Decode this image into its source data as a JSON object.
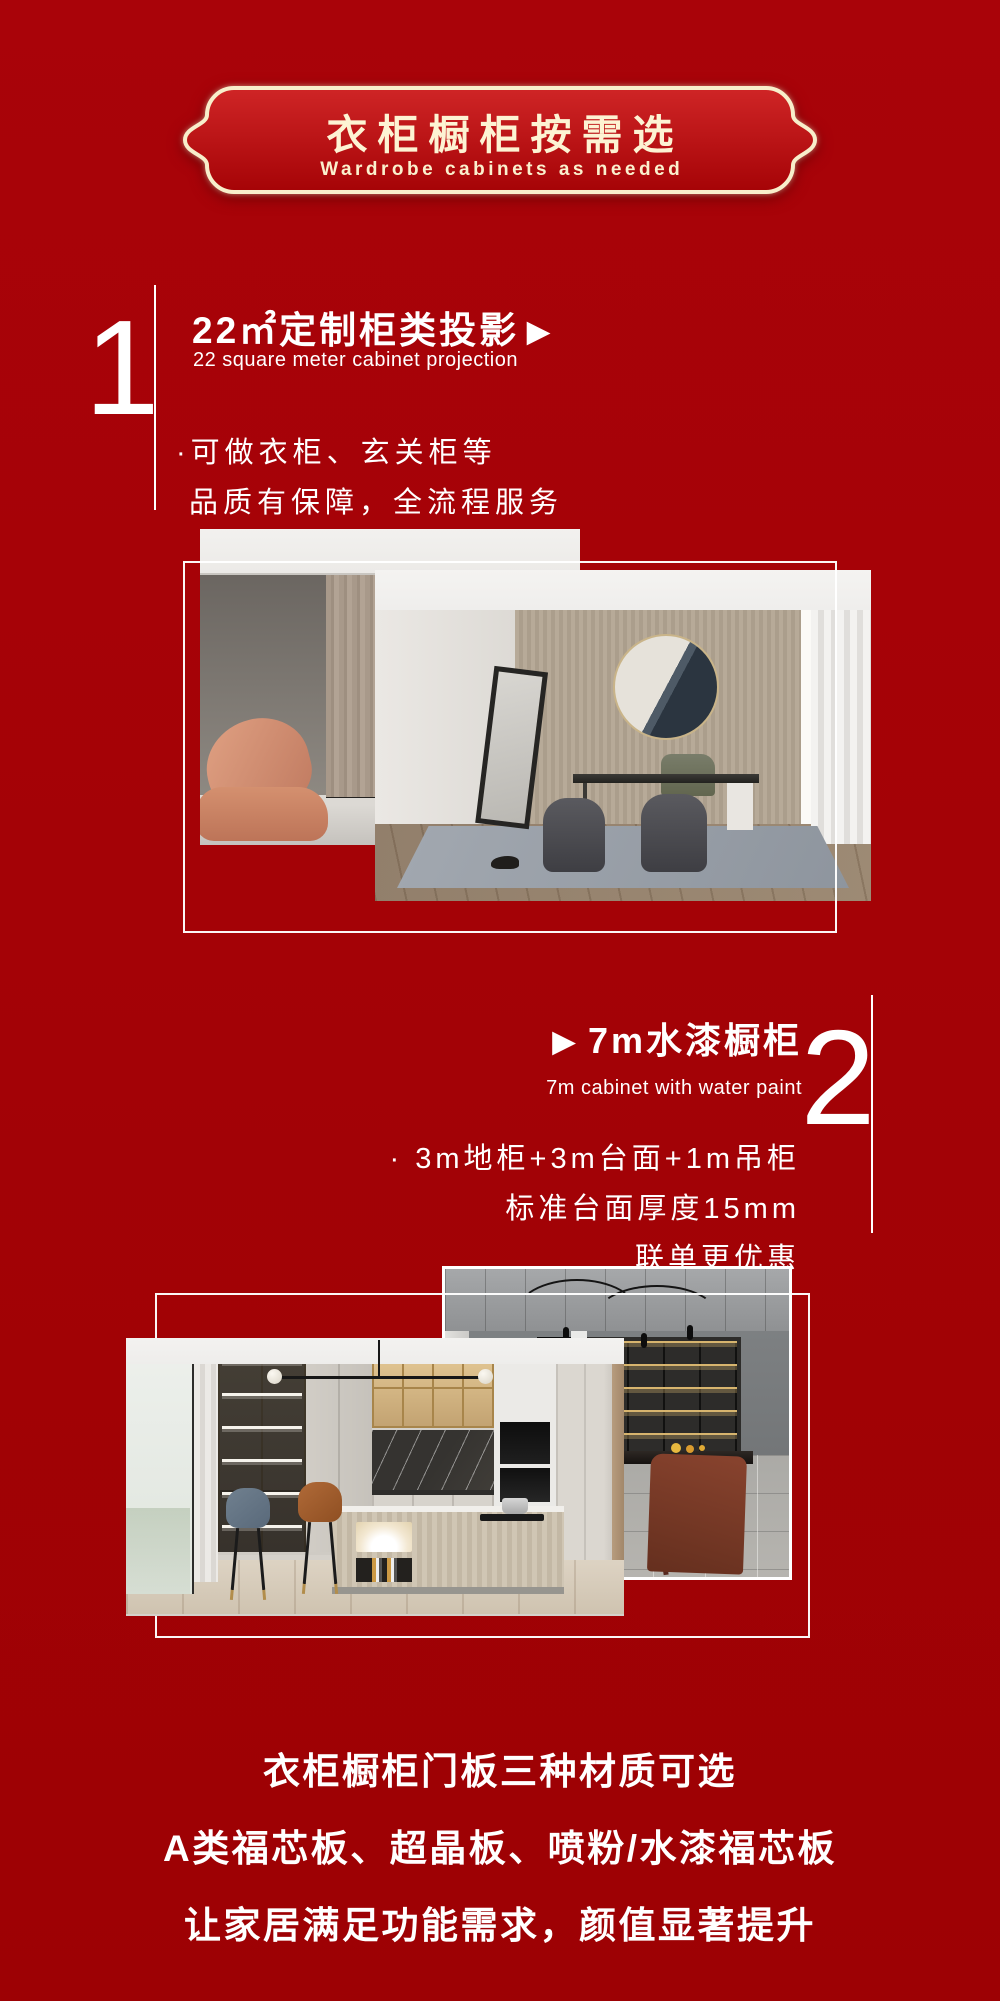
{
  "page": {
    "background": "#a40206",
    "text_color": "#ffffff"
  },
  "badge": {
    "title": "衣柜橱柜按需选",
    "subtitle": "Wardrobe cabinets as needed",
    "border_color": "#f8eecb",
    "text_color": "#fdf3d3",
    "fill_top": "#cf2526",
    "fill_bottom": "#a50306"
  },
  "section1": {
    "number": "1",
    "title": "22㎡定制柜类投影",
    "arrow": "▶",
    "subtitle": "22 square meter cabinet projection",
    "bullets": [
      "·可做衣柜、玄关柜等",
      "品质有保障，全流程服务"
    ],
    "photos": {
      "back": "living-room",
      "front": "study-room"
    }
  },
  "section2": {
    "number": "2",
    "arrow": "▶",
    "title": "7m水漆橱柜",
    "subtitle": "7m cabinet with water paint",
    "bullets": [
      "· 3m地柜+3m台面+1m吊柜",
      "标准台面厚度15mm",
      "联单更优惠"
    ],
    "photos": {
      "back": "dining-room",
      "front": "kitchen"
    }
  },
  "footer": {
    "lines": [
      "衣柜橱柜门板三种材质可选",
      "A类福芯板、超晶板、喷粉/水漆福芯板",
      "让家居满足功能需求，颜值显著提升"
    ]
  }
}
